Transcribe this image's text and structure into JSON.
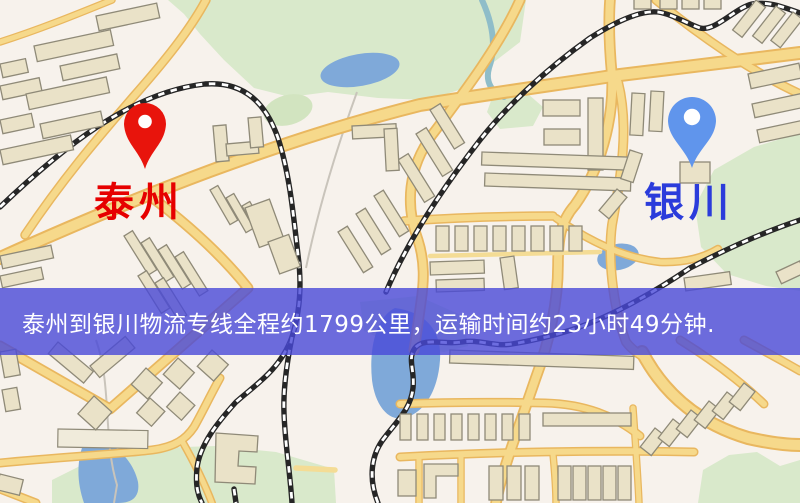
{
  "banner": {
    "text": "泰州到银川物流专线全程约1799公里，运输时间约23小时49分钟.",
    "background_color": "#4848d8",
    "text_color": "#ffffff"
  },
  "markers": [
    {
      "id": "origin",
      "city": "泰州",
      "pin": "red-pin",
      "pin_color": "#e8140c",
      "label_color": "#e60000"
    },
    {
      "id": "destination",
      "city": "银川",
      "pin": "blue-pin",
      "pin_color": "#6095ec",
      "label_color": "#2b3cdb"
    }
  ],
  "map": {
    "type": "static-city-map",
    "theme": {
      "background": "#f7f2ec",
      "road_fill": "#f6d98b",
      "road_casing": "#e9b75f",
      "minor_road": "#f4dc95",
      "park": "#d9e9cb",
      "water": "#7fa9d9",
      "building_fill": "#eae2c8",
      "building_stroke": "#8f8a78",
      "railway": "#262626"
    }
  }
}
